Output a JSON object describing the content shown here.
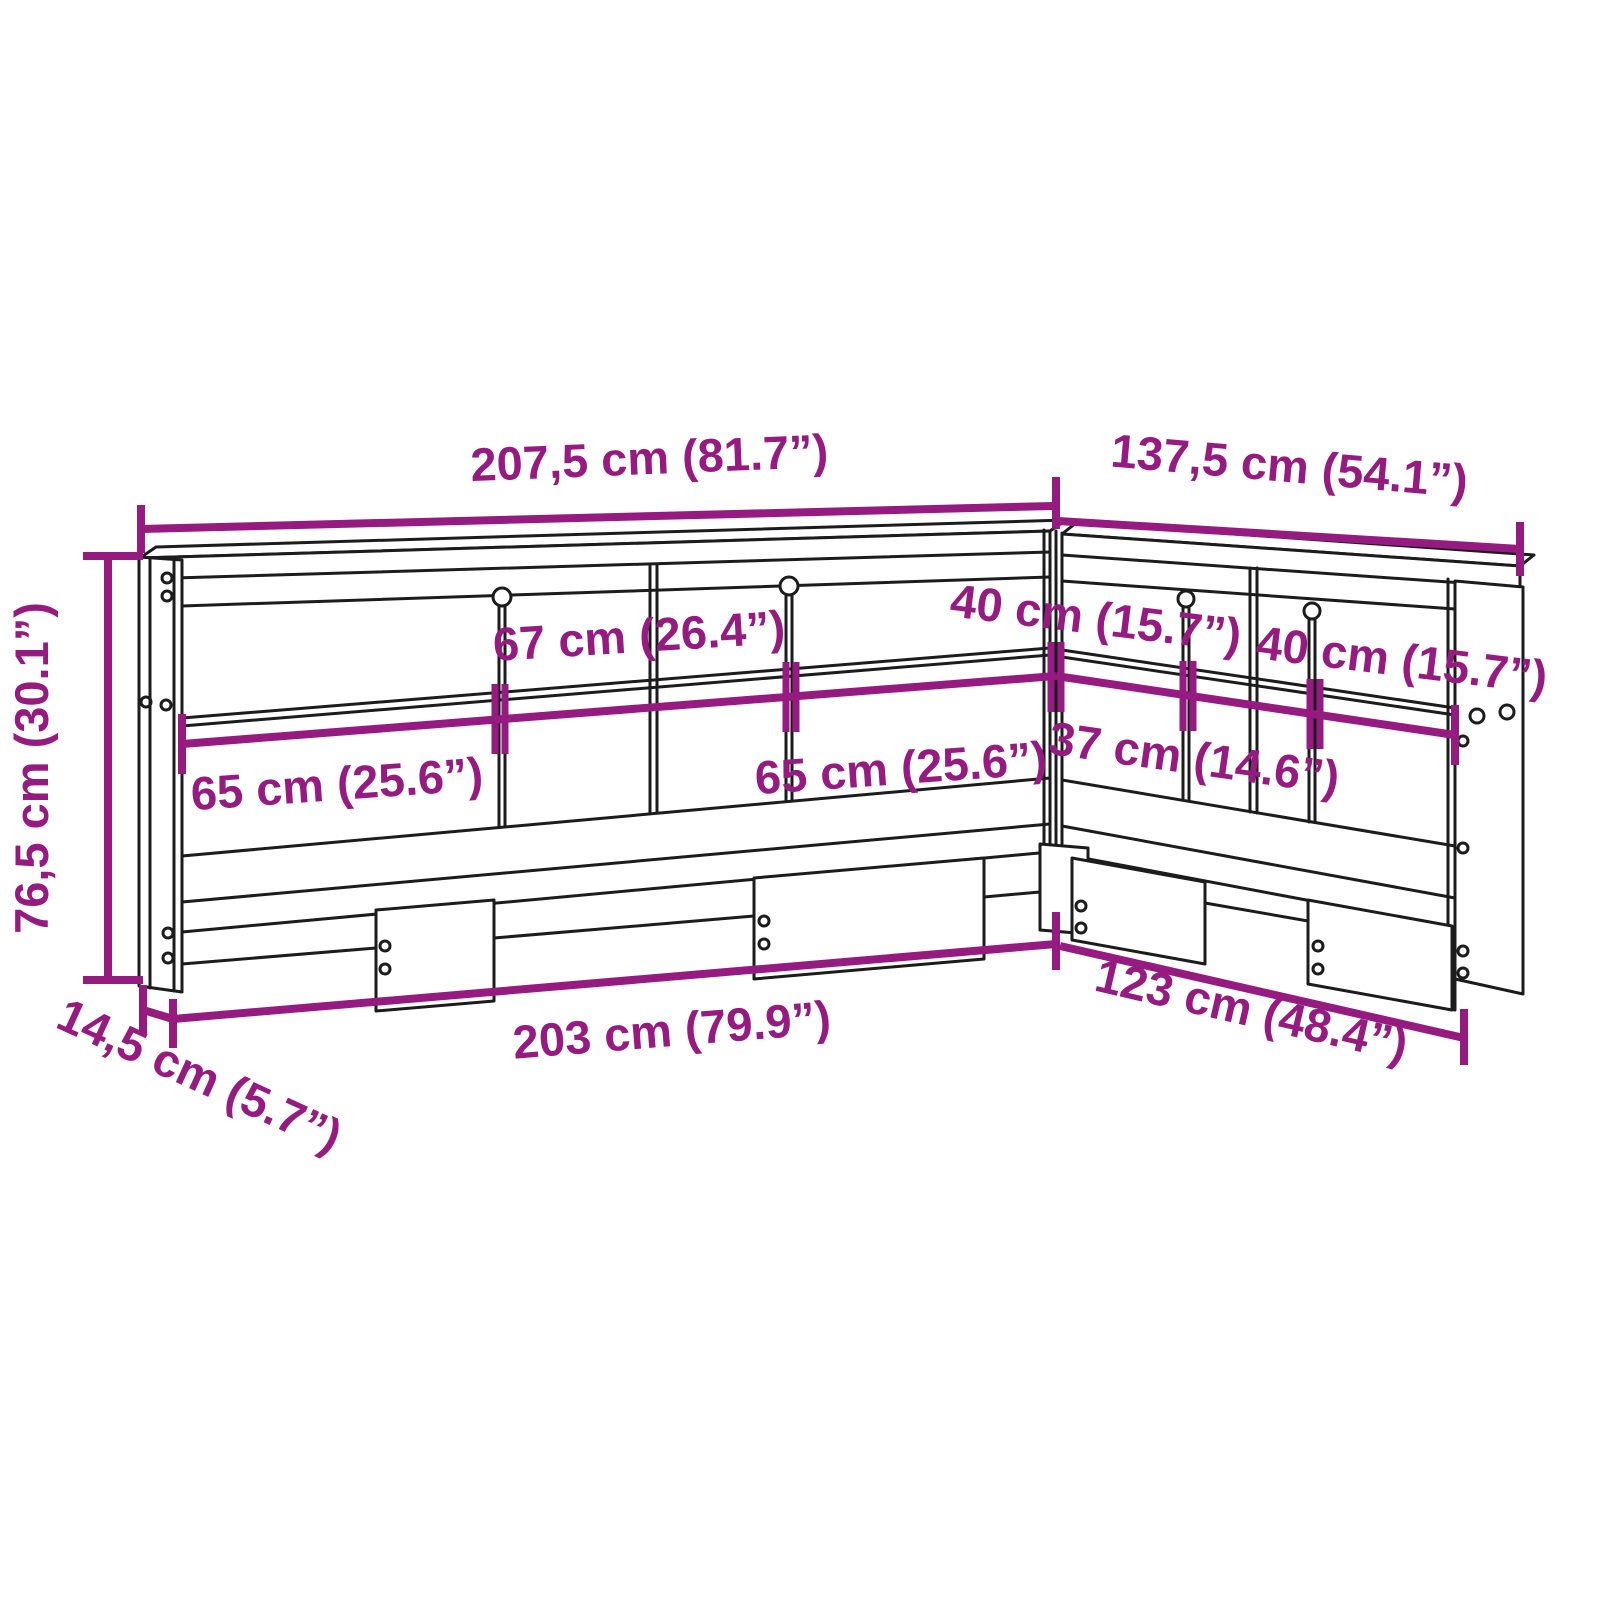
{
  "page": {
    "type": "furniture-dimension-diagram",
    "subject": "L-shaped bookcase headboard",
    "background": "#ffffff"
  },
  "colors": {
    "dimension_accent": "#951b81",
    "line_art": "#1c1c1c"
  },
  "labels": {
    "total_width_left": "207,5 cm (81.7”)",
    "total_width_right": "137,5 cm (54.1”)",
    "height": "76,5 cm (30.1”)",
    "depth": "14,5 cm (5.7”)",
    "opening_left_outer": "65 cm (25.6”)",
    "opening_left_center": "67 cm (26.4”)",
    "opening_left_inner": "65 cm (25.6”)",
    "opening_right_inner": "40 cm (15.7”)",
    "opening_right_center": "37 cm (14.6”)",
    "opening_right_outer": "40 cm (15.7”)",
    "base_width_left": "203 cm (79.9”)",
    "base_width_right": "123 cm (48.4”)"
  }
}
